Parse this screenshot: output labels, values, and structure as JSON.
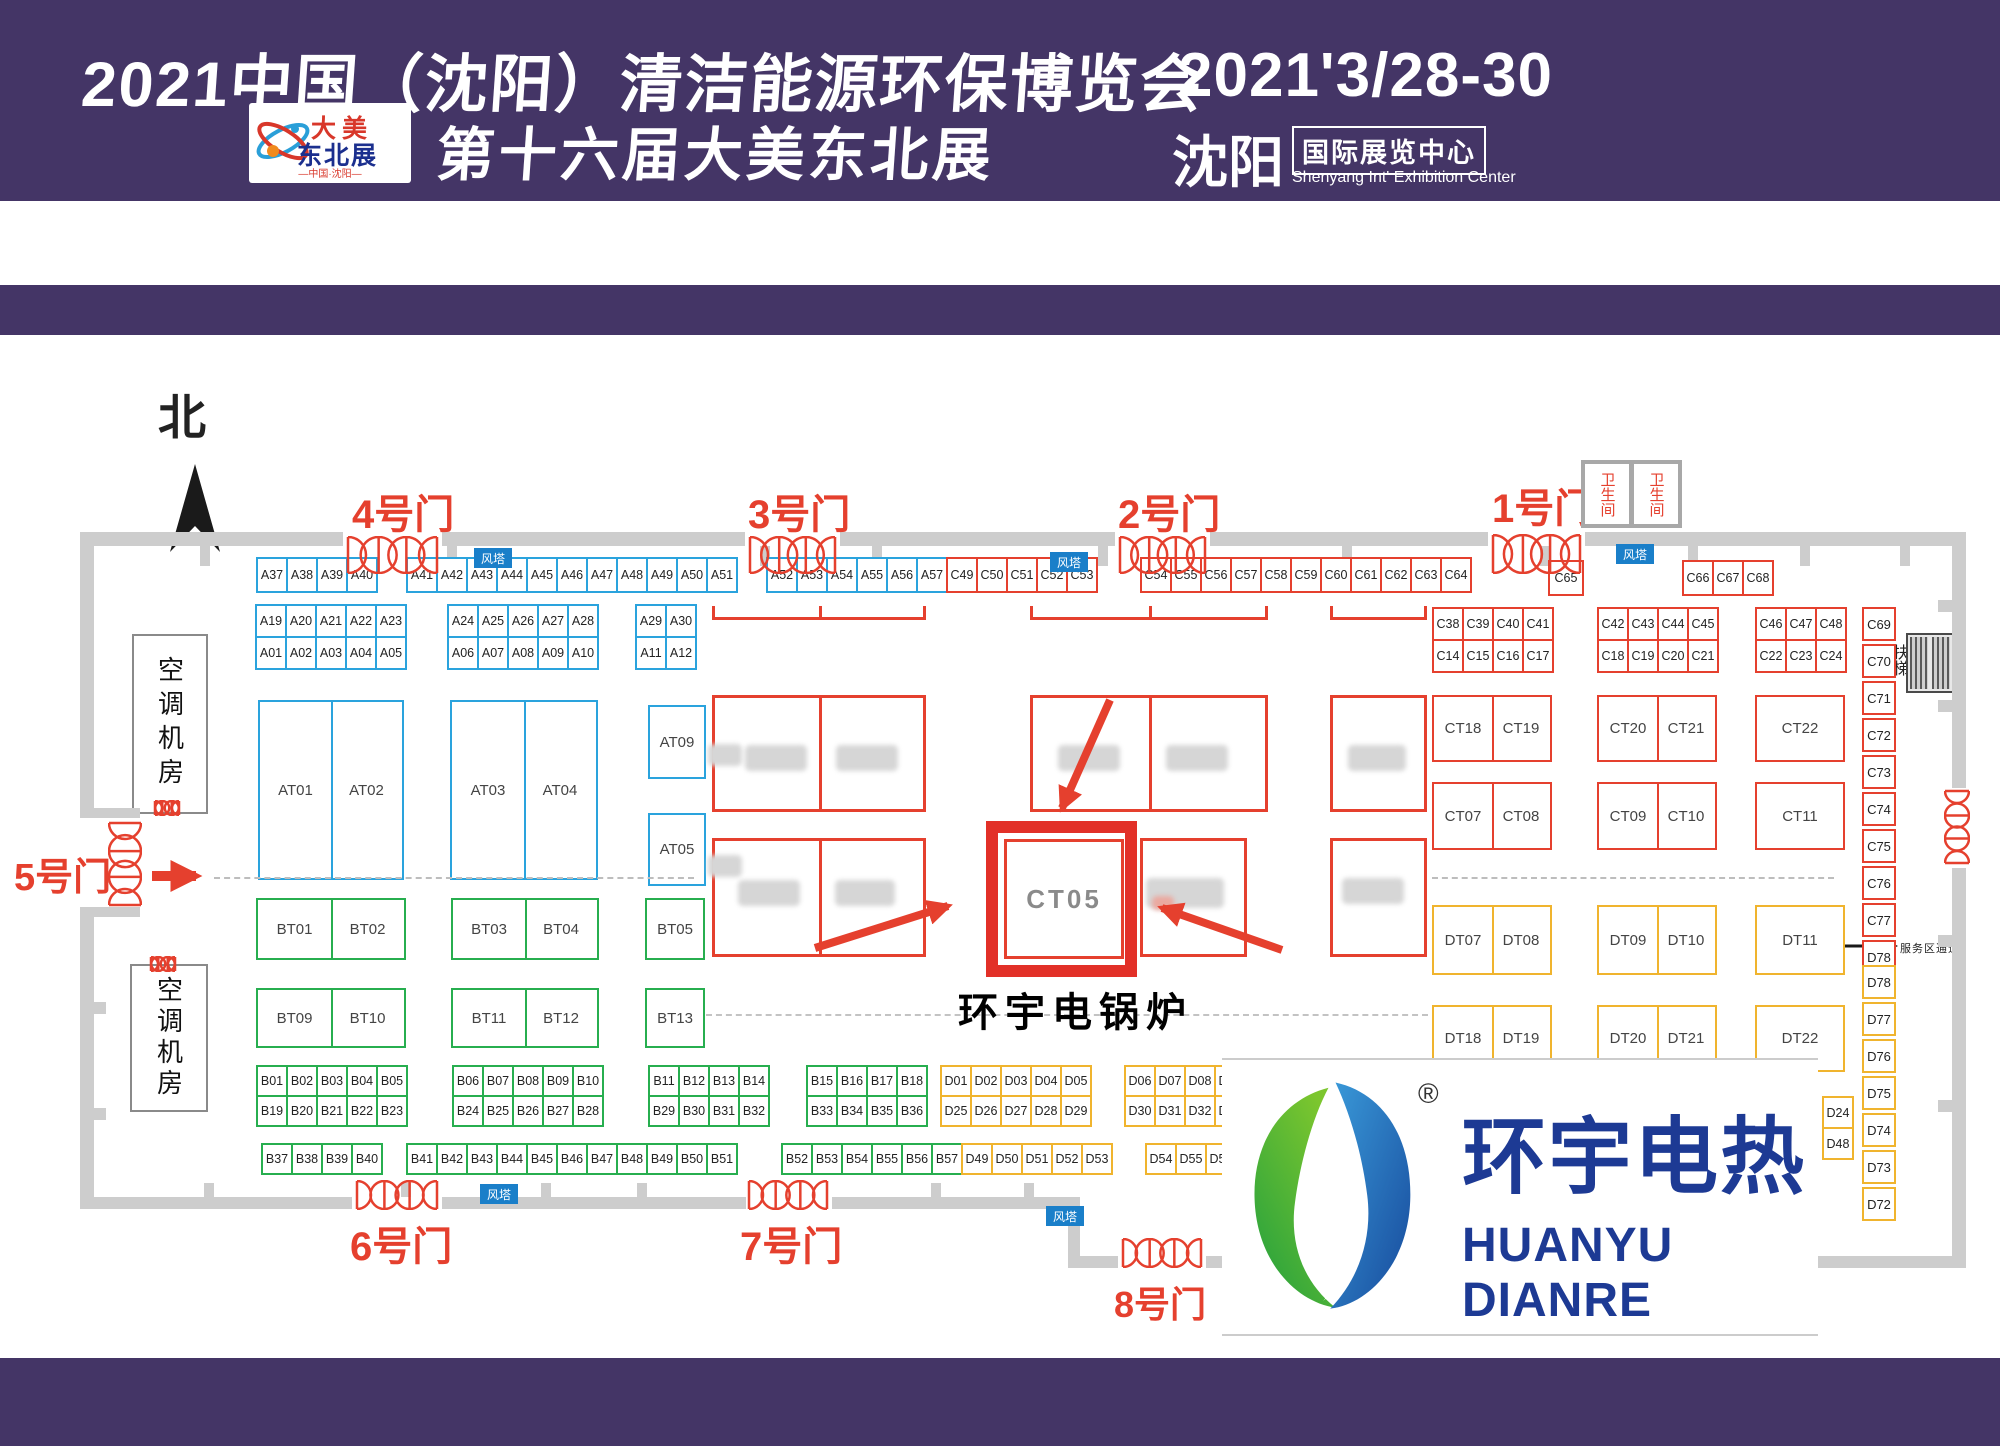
{
  "header": {
    "title_line1": "2021中国（沈阳）清洁能源环保博览会",
    "title_line2": "第十六届大美东北展",
    "date": "2021'3/28-30",
    "city": "沈阳",
    "venue": "国际展览中心",
    "venue_en": "Shenyang Int' Exhibition Center",
    "logo": {
      "line1": "大美",
      "line2": "东北展",
      "subtitle": "—中国·沈阳—"
    }
  },
  "colors": {
    "banner": "#443566",
    "booth_red": "#e5402e",
    "booth_blue": "#2aa3dd",
    "booth_green": "#27ae4f",
    "booth_yellow": "#f0b42e",
    "wall": "#cdcdcd",
    "wind_tower_badge": "#1a7fc9",
    "brand_blue": "#1d3a94",
    "highlight_red": "#e23028"
  },
  "map": {
    "north_label": "北",
    "wind_tower_label": "风塔",
    "restroom_label": "卫生间",
    "escalator_label": "扶梯",
    "service_aisle_label": "服务区通道",
    "ac_room_label": "空调机房",
    "gates": {
      "g1": "1号门",
      "g2": "2号门",
      "g3": "3号门",
      "g4": "4号门",
      "g5": "5号门",
      "g6": "6号门",
      "g7": "7号门",
      "g8": "8号门"
    },
    "highlight": {
      "booth": "CT05",
      "caption": "环宇电锅炉"
    },
    "booth_groups": [
      {
        "x": 256,
        "y": 557,
        "cols": 4,
        "rows": 1,
        "pw": 30,
        "ph": 34,
        "color": "blue",
        "labels": [
          "A37",
          "A38",
          "A39",
          "A40"
        ]
      },
      {
        "x": 406,
        "y": 557,
        "cols": 11,
        "rows": 1,
        "pw": 30,
        "ph": 34,
        "color": "blue",
        "labels": [
          "A41",
          "A42",
          "A43",
          "A44",
          "A45",
          "A46",
          "A47",
          "A48",
          "A49",
          "A50",
          "A51"
        ]
      },
      {
        "x": 766,
        "y": 557,
        "cols": 6,
        "rows": 1,
        "pw": 30,
        "ph": 34,
        "color": "blue",
        "labels": [
          "A52",
          "A53",
          "A54",
          "A55",
          "A56",
          "A57"
        ]
      },
      {
        "x": 946,
        "y": 557,
        "cols": 5,
        "rows": 1,
        "pw": 30,
        "ph": 34,
        "color": "red",
        "labels": [
          "C49",
          "C50",
          "C51",
          "C52",
          "C53"
        ]
      },
      {
        "x": 1140,
        "y": 557,
        "cols": 11,
        "rows": 1,
        "pw": 30,
        "ph": 34,
        "color": "red",
        "labels": [
          "C54",
          "C55",
          "C56",
          "C57",
          "C58",
          "C59",
          "C60",
          "C61",
          "C62",
          "C63",
          "C64"
        ]
      },
      {
        "x": 1548,
        "y": 560,
        "cols": 1,
        "rows": 1,
        "pw": 34,
        "ph": 34,
        "color": "red",
        "labels": [
          "C65"
        ]
      },
      {
        "x": 1682,
        "y": 560,
        "cols": 3,
        "rows": 1,
        "pw": 30,
        "ph": 34,
        "color": "red",
        "labels": [
          "C66",
          "C67",
          "C68"
        ]
      },
      {
        "x": 255,
        "y": 604,
        "cols": 5,
        "rows": 2,
        "pw": 30,
        "ph": 32,
        "color": "blue",
        "labels": [
          "A19",
          "A20",
          "A21",
          "A22",
          "A23",
          "A01",
          "A02",
          "A03",
          "A04",
          "A05"
        ]
      },
      {
        "x": 447,
        "y": 604,
        "cols": 5,
        "rows": 2,
        "pw": 30,
        "ph": 32,
        "color": "blue",
        "labels": [
          "A24",
          "A25",
          "A26",
          "A27",
          "A28",
          "A06",
          "A07",
          "A08",
          "A09",
          "A10"
        ]
      },
      {
        "x": 635,
        "y": 604,
        "cols": 2,
        "rows": 2,
        "pw": 30,
        "ph": 32,
        "color": "blue",
        "labels": [
          "A29",
          "A30",
          "A11",
          "A12"
        ]
      },
      {
        "x": 1432,
        "y": 607,
        "cols": 4,
        "rows": 2,
        "pw": 30,
        "ph": 32,
        "color": "red",
        "labels": [
          "C38",
          "C39",
          "C40",
          "C41",
          "C14",
          "C15",
          "C16",
          "C17"
        ]
      },
      {
        "x": 1597,
        "y": 607,
        "cols": 4,
        "rows": 2,
        "pw": 30,
        "ph": 32,
        "color": "red",
        "labels": [
          "C42",
          "C43",
          "C44",
          "C45",
          "C18",
          "C19",
          "C20",
          "C21"
        ]
      },
      {
        "x": 1755,
        "y": 607,
        "cols": 3,
        "rows": 2,
        "pw": 30,
        "ph": 32,
        "color": "red",
        "labels": [
          "C46",
          "C47",
          "C48",
          "C22",
          "C23",
          "C24"
        ]
      },
      {
        "x": 256,
        "y": 1065,
        "cols": 5,
        "rows": 2,
        "pw": 30,
        "ph": 30,
        "color": "green",
        "labels": [
          "B01",
          "B02",
          "B03",
          "B04",
          "B05",
          "B19",
          "B20",
          "B21",
          "B22",
          "B23"
        ]
      },
      {
        "x": 452,
        "y": 1065,
        "cols": 5,
        "rows": 2,
        "pw": 30,
        "ph": 30,
        "color": "green",
        "labels": [
          "B06",
          "B07",
          "B08",
          "B09",
          "B10",
          "B24",
          "B25",
          "B26",
          "B27",
          "B28"
        ]
      },
      {
        "x": 648,
        "y": 1065,
        "cols": 4,
        "rows": 2,
        "pw": 30,
        "ph": 30,
        "color": "green",
        "labels": [
          "B11",
          "B12",
          "B13",
          "B14",
          "B29",
          "B30",
          "B31",
          "B32"
        ]
      },
      {
        "x": 806,
        "y": 1065,
        "cols": 4,
        "rows": 2,
        "pw": 30,
        "ph": 30,
        "color": "green",
        "labels": [
          "B15",
          "B16",
          "B17",
          "B18",
          "B33",
          "B34",
          "B35",
          "B36"
        ]
      },
      {
        "x": 940,
        "y": 1065,
        "cols": 5,
        "rows": 2,
        "pw": 30,
        "ph": 30,
        "color": "yellow",
        "labels": [
          "D01",
          "D02",
          "D03",
          "D04",
          "D05",
          "D25",
          "D26",
          "D27",
          "D28",
          "D29"
        ]
      },
      {
        "x": 1124,
        "y": 1065,
        "cols": 4,
        "rows": 2,
        "pw": 30,
        "ph": 30,
        "color": "yellow",
        "labels": [
          "D06",
          "D07",
          "D08",
          "D09",
          "D30",
          "D31",
          "D32",
          "D33"
        ]
      },
      {
        "x": 261,
        "y": 1143,
        "cols": 4,
        "rows": 1,
        "pw": 30,
        "ph": 30,
        "color": "green",
        "labels": [
          "B37",
          "B38",
          "B39",
          "B40"
        ]
      },
      {
        "x": 406,
        "y": 1143,
        "cols": 11,
        "rows": 1,
        "pw": 30,
        "ph": 30,
        "color": "green",
        "labels": [
          "B41",
          "B42",
          "B43",
          "B44",
          "B45",
          "B46",
          "B47",
          "B48",
          "B49",
          "B50",
          "B51"
        ]
      },
      {
        "x": 781,
        "y": 1143,
        "cols": 6,
        "rows": 1,
        "pw": 30,
        "ph": 30,
        "color": "green",
        "labels": [
          "B52",
          "B53",
          "B54",
          "B55",
          "B56",
          "B57"
        ]
      },
      {
        "x": 961,
        "y": 1143,
        "cols": 5,
        "rows": 1,
        "pw": 30,
        "ph": 30,
        "color": "yellow",
        "labels": [
          "D49",
          "D50",
          "D51",
          "D52",
          "D53"
        ]
      },
      {
        "x": 1145,
        "y": 1143,
        "cols": 3,
        "rows": 1,
        "pw": 30,
        "ph": 30,
        "color": "yellow",
        "labels": [
          "D54",
          "D55",
          "D56"
        ]
      },
      {
        "x": 1822,
        "y": 1096,
        "cols": 1,
        "rows": 2,
        "pw": 30,
        "ph": 31,
        "color": "yellow",
        "labels": [
          "D24",
          "D48"
        ]
      }
    ],
    "stack_groups": [
      {
        "x": 1862,
        "y": 607,
        "w": 34,
        "h": 34,
        "pitch": 37,
        "color": "red",
        "labels": [
          "C69",
          "C70",
          "C71",
          "C72",
          "C73",
          "C74",
          "C75",
          "C76",
          "C77",
          "D78"
        ]
      },
      {
        "x": 1862,
        "y": 965,
        "w": 34,
        "h": 34,
        "pitch": 37,
        "color": "yellow",
        "labels": [
          "D78",
          "D77",
          "D76",
          "D75",
          "D74",
          "D73",
          "D72"
        ]
      }
    ],
    "rooms": [
      {
        "x": 258,
        "y": 700,
        "w": 146,
        "h": 180,
        "color": "blue",
        "labels": [
          "AT01",
          "AT02"
        ]
      },
      {
        "x": 450,
        "y": 700,
        "w": 148,
        "h": 180,
        "color": "blue",
        "labels": [
          "AT03",
          "AT04"
        ]
      },
      {
        "x": 648,
        "y": 705,
        "w": 58,
        "h": 74,
        "color": "blue",
        "labels": [
          "AT09"
        ]
      },
      {
        "x": 648,
        "y": 813,
        "w": 58,
        "h": 73,
        "color": "blue",
        "labels": [
          "AT05"
        ]
      },
      {
        "x": 1432,
        "y": 695,
        "w": 120,
        "h": 67,
        "color": "red",
        "labels": [
          "CT18",
          "CT19"
        ]
      },
      {
        "x": 1597,
        "y": 695,
        "w": 120,
        "h": 67,
        "color": "red",
        "labels": [
          "CT20",
          "CT21"
        ]
      },
      {
        "x": 1755,
        "y": 695,
        "w": 90,
        "h": 67,
        "color": "red",
        "labels": [
          "CT22"
        ]
      },
      {
        "x": 1432,
        "y": 782,
        "w": 120,
        "h": 68,
        "color": "red",
        "labels": [
          "CT07",
          "CT08"
        ]
      },
      {
        "x": 1597,
        "y": 782,
        "w": 120,
        "h": 68,
        "color": "red",
        "labels": [
          "CT09",
          "CT10"
        ]
      },
      {
        "x": 1755,
        "y": 782,
        "w": 90,
        "h": 68,
        "color": "red",
        "labels": [
          "CT11"
        ]
      },
      {
        "x": 256,
        "y": 898,
        "w": 150,
        "h": 62,
        "color": "green",
        "labels": [
          "BT01",
          "BT02"
        ]
      },
      {
        "x": 451,
        "y": 898,
        "w": 148,
        "h": 62,
        "color": "green",
        "labels": [
          "BT03",
          "BT04"
        ]
      },
      {
        "x": 645,
        "y": 898,
        "w": 60,
        "h": 62,
        "color": "green",
        "labels": [
          "BT05"
        ]
      },
      {
        "x": 256,
        "y": 988,
        "w": 150,
        "h": 60,
        "color": "green",
        "labels": [
          "BT09",
          "BT10"
        ]
      },
      {
        "x": 451,
        "y": 988,
        "w": 148,
        "h": 60,
        "color": "green",
        "labels": [
          "BT11",
          "BT12"
        ]
      },
      {
        "x": 645,
        "y": 988,
        "w": 60,
        "h": 60,
        "color": "green",
        "labels": [
          "BT13"
        ]
      },
      {
        "x": 1432,
        "y": 905,
        "w": 120,
        "h": 70,
        "color": "yellow",
        "labels": [
          "DT07",
          "DT08"
        ]
      },
      {
        "x": 1597,
        "y": 905,
        "w": 120,
        "h": 70,
        "color": "yellow",
        "labels": [
          "DT09",
          "DT10"
        ]
      },
      {
        "x": 1755,
        "y": 905,
        "w": 90,
        "h": 70,
        "color": "yellow",
        "labels": [
          "DT11"
        ]
      },
      {
        "x": 1432,
        "y": 1005,
        "w": 120,
        "h": 67,
        "color": "yellow",
        "labels": [
          "DT18",
          "DT19"
        ]
      },
      {
        "x": 1597,
        "y": 1005,
        "w": 120,
        "h": 67,
        "color": "yellow",
        "labels": [
          "DT20",
          "DT21"
        ]
      },
      {
        "x": 1755,
        "y": 1005,
        "w": 90,
        "h": 67,
        "color": "yellow",
        "labels": [
          "DT22"
        ]
      }
    ]
  },
  "logo_panel": {
    "brand_cn": "环宇电热",
    "brand_en": "HUANYU DIANRE",
    "registered": "®"
  }
}
